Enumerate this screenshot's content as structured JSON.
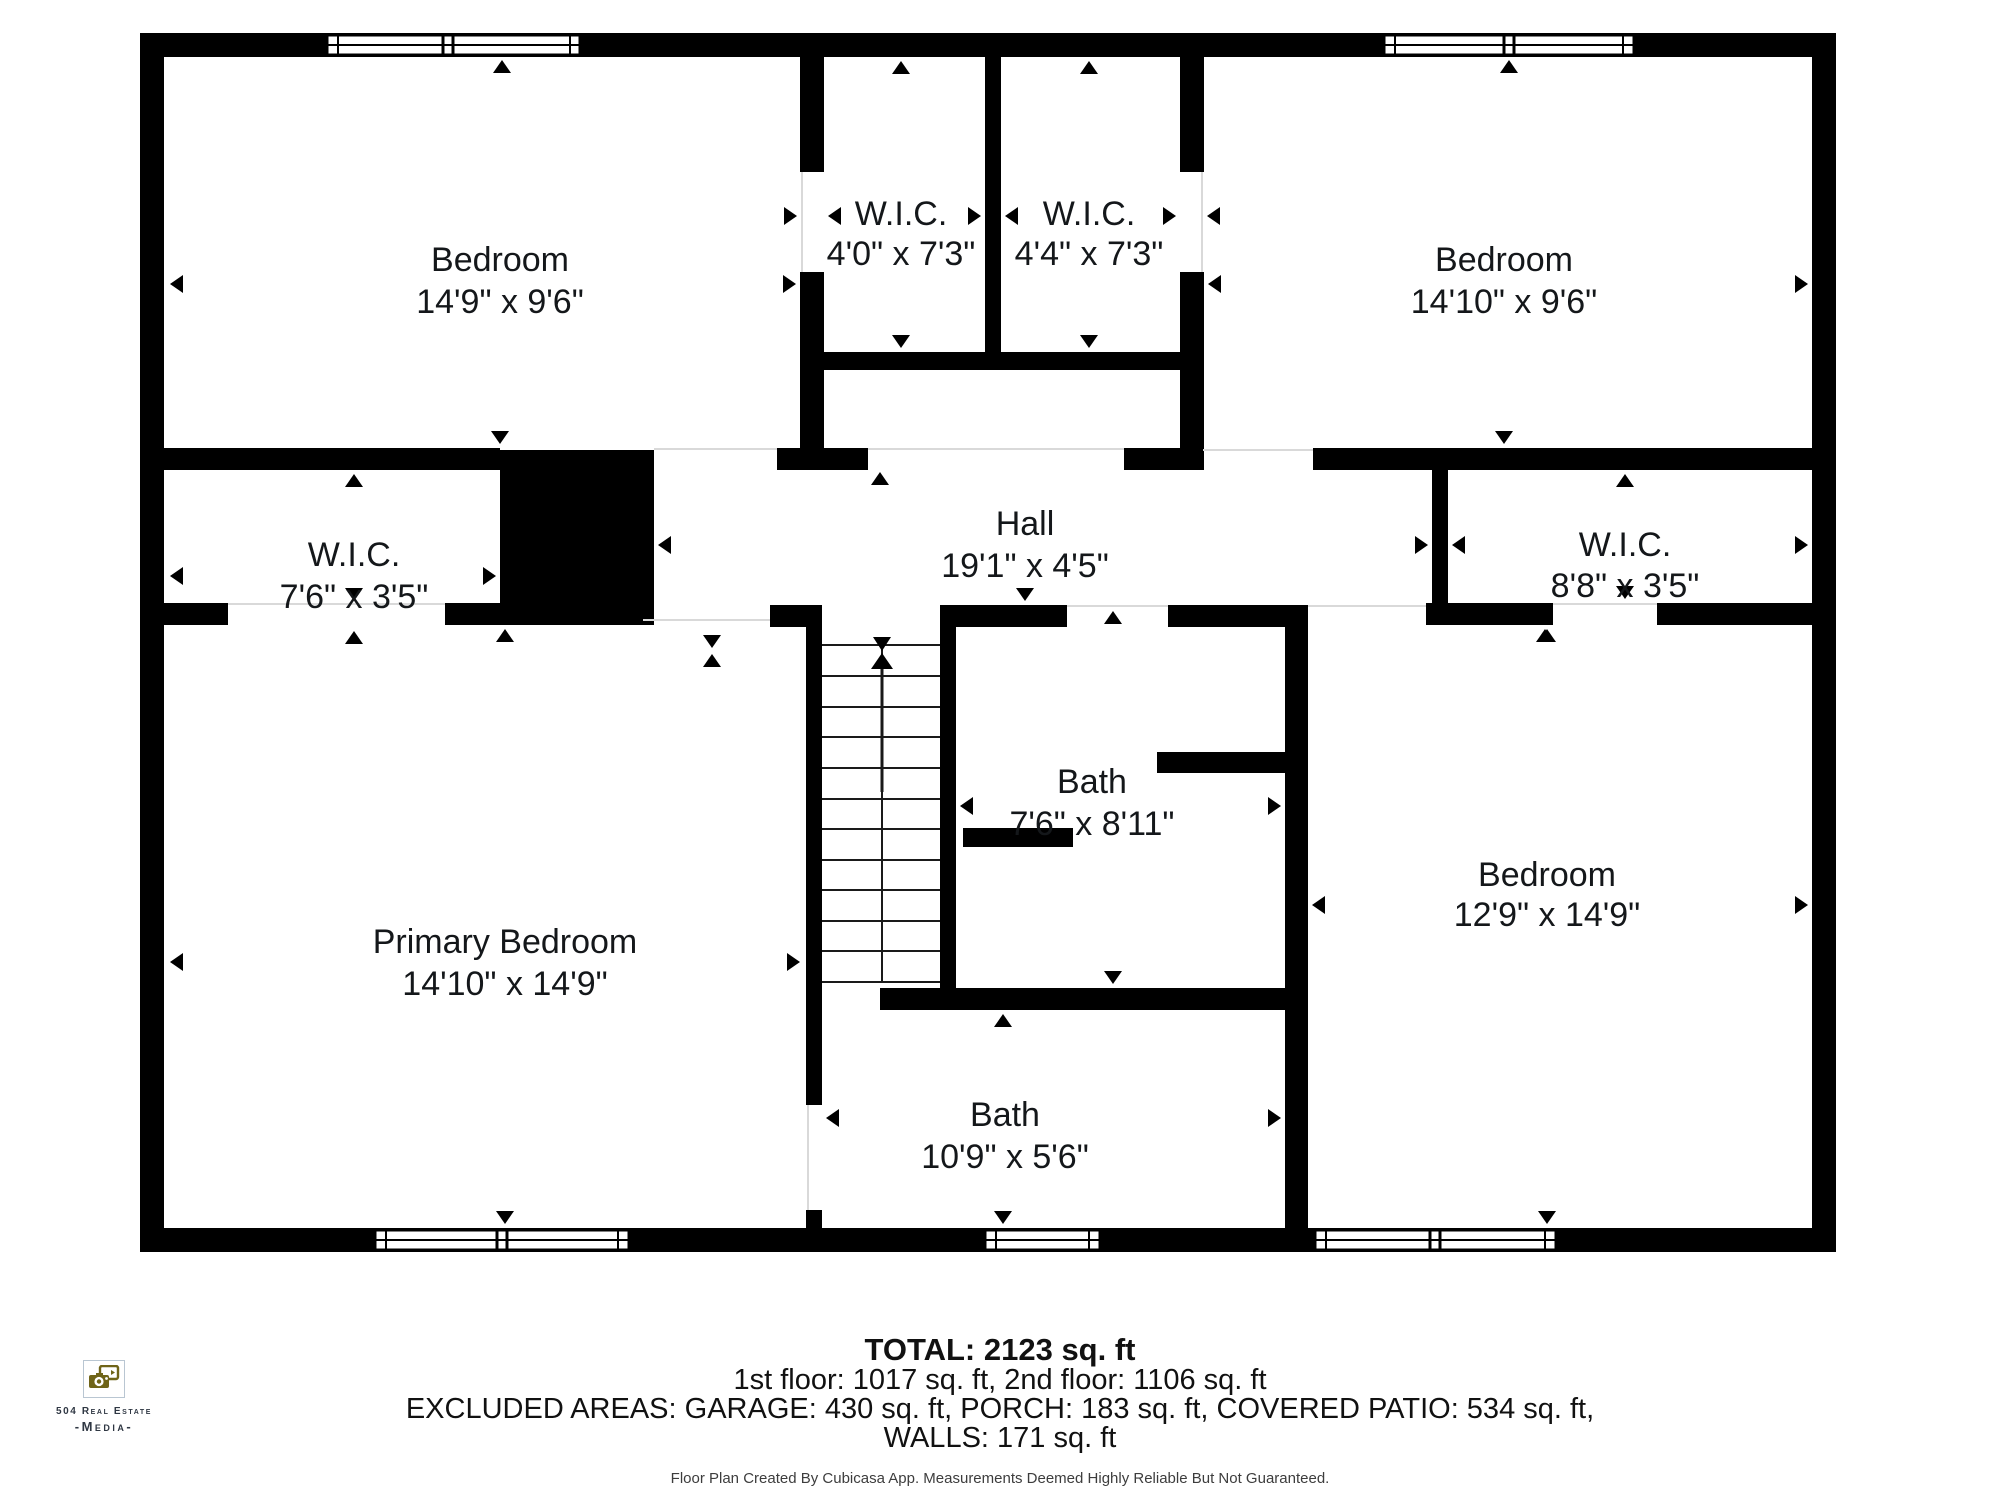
{
  "rooms": [
    {
      "name": "Bedroom",
      "dims": "14'9\" x 9'6\""
    },
    {
      "name": "W.I.C.",
      "dims": "4'0\" x 7'3\""
    },
    {
      "name": "W.I.C.",
      "dims": "4'4\" x 7'3\""
    },
    {
      "name": "Bedroom",
      "dims": "14'10\" x 9'6\""
    },
    {
      "name": "W.I.C.",
      "dims": "7'6\" x 3'5\""
    },
    {
      "name": "Hall",
      "dims": "19'1\" x 4'5\""
    },
    {
      "name": "W.I.C.",
      "dims": "8'8\" x 3'5\""
    },
    {
      "name": "Primary Bedroom",
      "dims": "14'10\" x 14'9\""
    },
    {
      "name": "Bath",
      "dims": "7'6\" x 8'11\""
    },
    {
      "name": "Bath",
      "dims": "10'9\" x 5'6\""
    },
    {
      "name": "Bedroom",
      "dims": "12'9\" x 14'9\""
    }
  ],
  "summary": {
    "total": "TOTAL: 2123 sq. ft",
    "floors": "1st floor: 1017 sq. ft, 2nd floor: 1106 sq. ft",
    "excluded": "EXCLUDED AREAS: GARAGE: 430 sq. ft, PORCH: 183 sq. ft, COVERED PATIO: 534 sq. ft,",
    "walls": "WALLS: 171 sq. ft",
    "disclaimer": "Floor Plan Created By Cubicasa App. Measurements Deemed Highly Reliable But Not Guaranteed."
  },
  "branding": {
    "line1": "504 Real Estate",
    "line2": "-Media-"
  },
  "colors": {
    "wall": "#000000",
    "label_text": "#14171a",
    "logo_olive": "#6f6418",
    "logo_border": "#b9c6d2"
  }
}
